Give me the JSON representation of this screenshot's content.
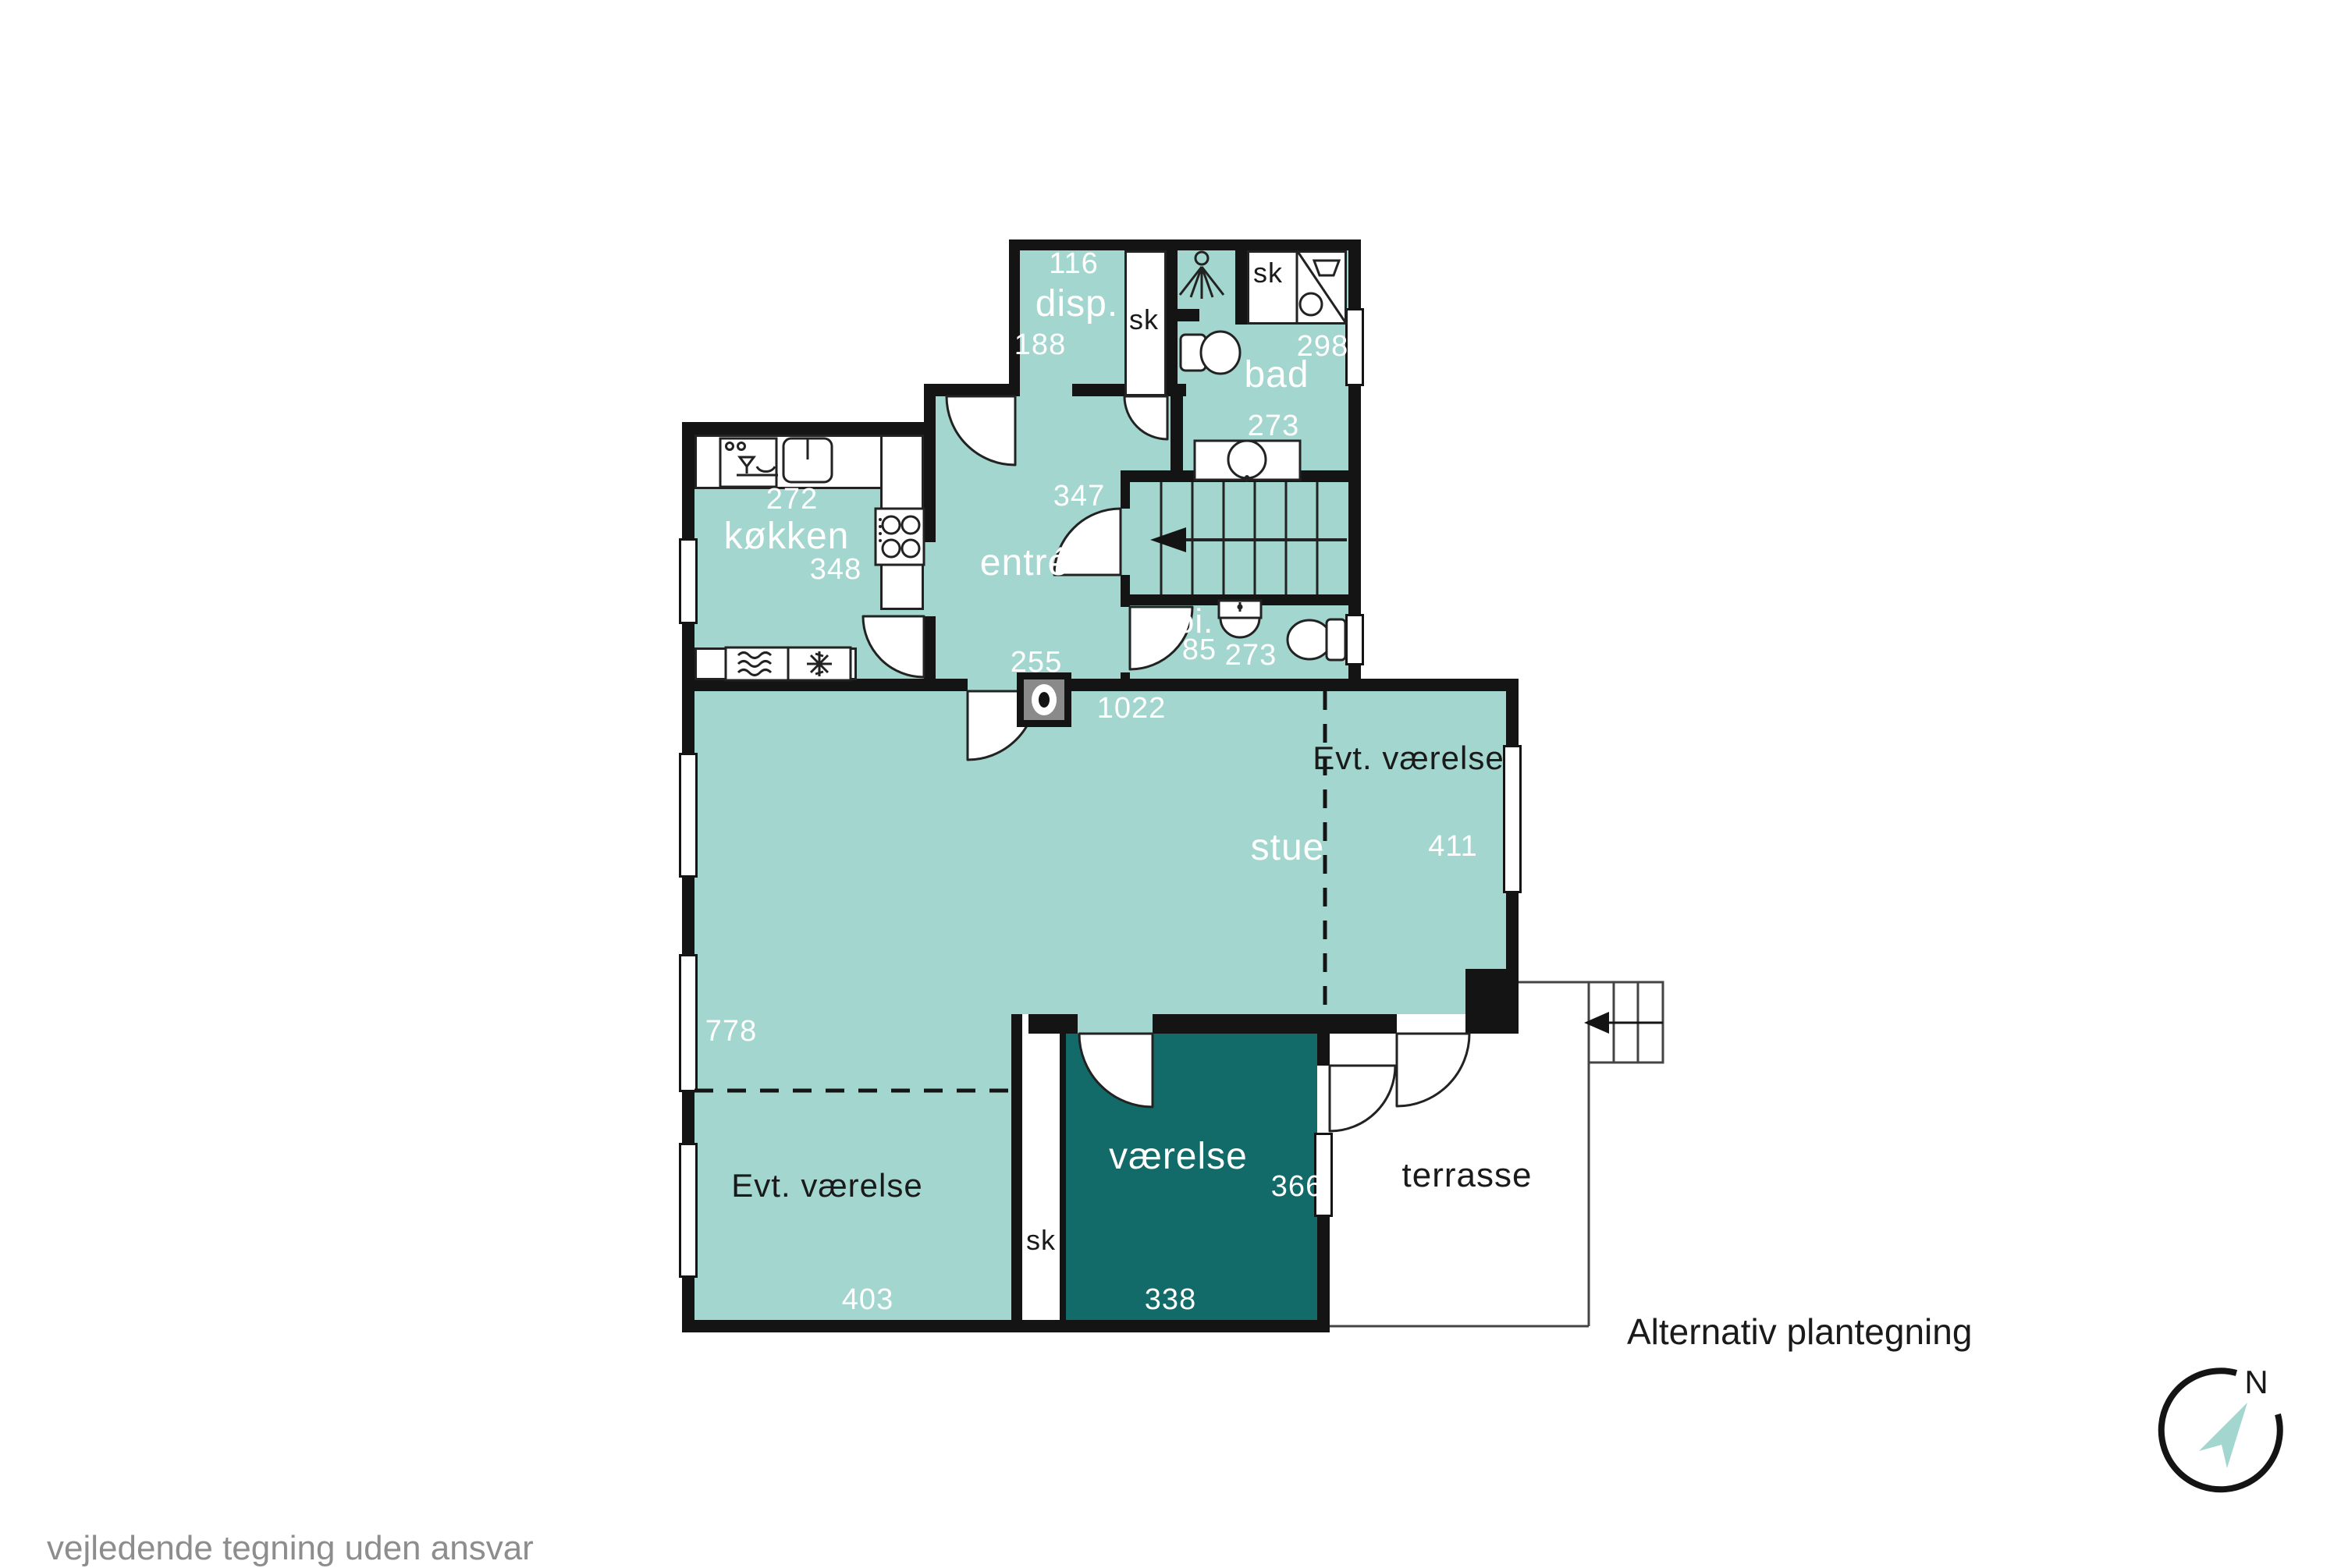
{
  "footer": {
    "caption": "Alternativ plantegning",
    "disclaimer": "vejledende tegning uden ansvar"
  },
  "compass": {
    "north_label": "N"
  },
  "colors": {
    "room_fill": "#a3d6ce",
    "dark_room_fill": "#126b68",
    "wall": "#141414",
    "background": "#ffffff",
    "disclaimer_text": "#8d8d8d",
    "room_label_light": "#ffffff",
    "room_label_dark": "#1a1a1a",
    "compass_arrow": "#a3d6ce"
  },
  "rooms": {
    "disp": {
      "name": "disp.",
      "width_cm": "116",
      "depth_cm": "188"
    },
    "bad": {
      "name": "bad",
      "width_cm": "273",
      "depth_cm": "298"
    },
    "koekken": {
      "name": "køkken",
      "width_cm": "272",
      "depth_cm": "348"
    },
    "entre": {
      "name": "entré",
      "width_cm": "255",
      "depth_cm": "347"
    },
    "toi": {
      "name": "toi.",
      "width_cm": "273",
      "depth_cm": "85"
    },
    "stue": {
      "name": "stue",
      "width_cm": "1022",
      "depth_cm": "778"
    },
    "evt_vaerelse_top": {
      "name": "Evt. værelse",
      "width_cm": "411"
    },
    "evt_vaerelse_bottom": {
      "name": "Evt. værelse",
      "width_cm": "403"
    },
    "vaerelse": {
      "name": "værelse",
      "width_cm": "338",
      "depth_cm": "366"
    },
    "terrasse": {
      "name": "terrasse"
    }
  },
  "closets": {
    "disp_closet": "sk",
    "bad_closet": "sk",
    "vaerelse_closet": "sk"
  },
  "icons": {
    "shower-icon": "shower head with spray lines",
    "washer-closet-icon": "laundry basin and drum with diagonal divider",
    "toilet-icon": "toilet with tank",
    "hand-basin-icon": "half round wall basin",
    "bath-sink-icon": "oval sink on console",
    "dishwasher-icon": "glass and bowl",
    "kitchen-sink-icon": "single bowl sink",
    "stove-icon": "four burner cooktop",
    "fridge-icon": "cool waves",
    "freezer-icon": "snowflake",
    "fireplace-icon": "wood stove",
    "stairs-icon": "staircase with down arrow",
    "outdoor-steps-icon": "terrace steps with arrow",
    "compass-icon": "north compass with arrow"
  }
}
